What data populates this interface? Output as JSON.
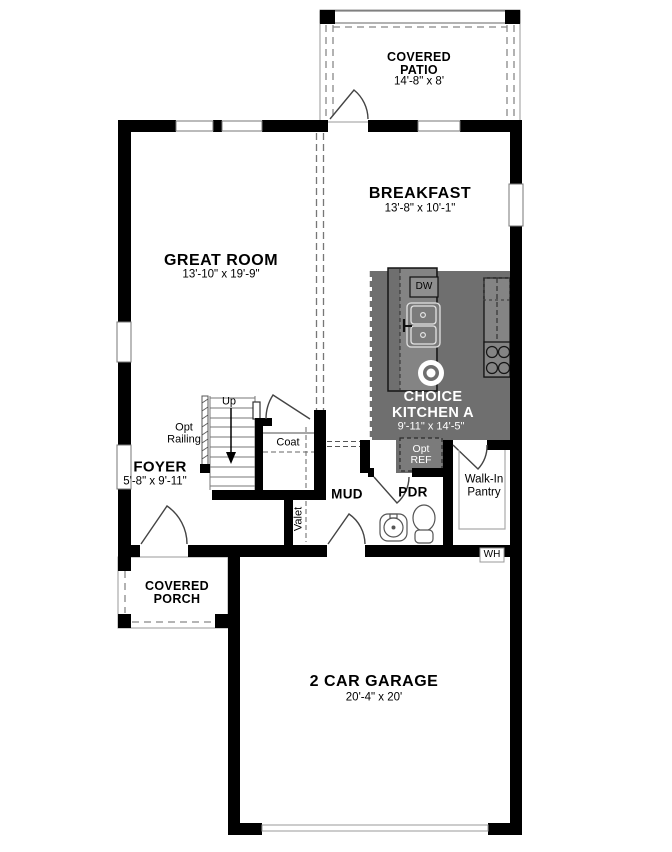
{
  "colors": {
    "wall": "#000000",
    "kitchen": "#6f6f6f",
    "counter": "#848484",
    "appliance": "#8e8e8e",
    "outline": "#9a9a9a",
    "kitchen_text": "#ffffff",
    "text": "#000000"
  },
  "rooms": {
    "patio": {
      "line1": "COVERED",
      "line2": "PATIO",
      "dims": "14'-8\" x 8'"
    },
    "breakfast": {
      "name": "BREAKFAST",
      "dims": "13'-8\" x 10'-1\""
    },
    "great_room": {
      "name": "GREAT ROOM",
      "dims": "13'-10\" x 19'-9\""
    },
    "kitchen": {
      "line1": "CHOICE",
      "line2": "KITCHEN A",
      "dims": "9'-11\" x 14'-5\""
    },
    "foyer": {
      "name": "FOYER",
      "dims": "5'-8\" x 9'-11\""
    },
    "porch": {
      "line1": "COVERED",
      "line2": "PORCH"
    },
    "garage": {
      "name": "2 CAR GARAGE",
      "dims": "20'-4\" x 20'"
    },
    "mud": {
      "name": "MUD"
    },
    "pdr": {
      "name": "PDR"
    },
    "pantry": {
      "line1": "Walk-In",
      "line2": "Pantry"
    },
    "coat": {
      "name": "Coat"
    },
    "valet": {
      "name": "Valet"
    }
  },
  "annotations": {
    "up": "Up",
    "opt_railing_line1": "Opt",
    "opt_railing_line2": "Railing",
    "opt_ref_line1": "Opt",
    "opt_ref_line2": "REF",
    "dw": "DW",
    "wh": "WH"
  }
}
